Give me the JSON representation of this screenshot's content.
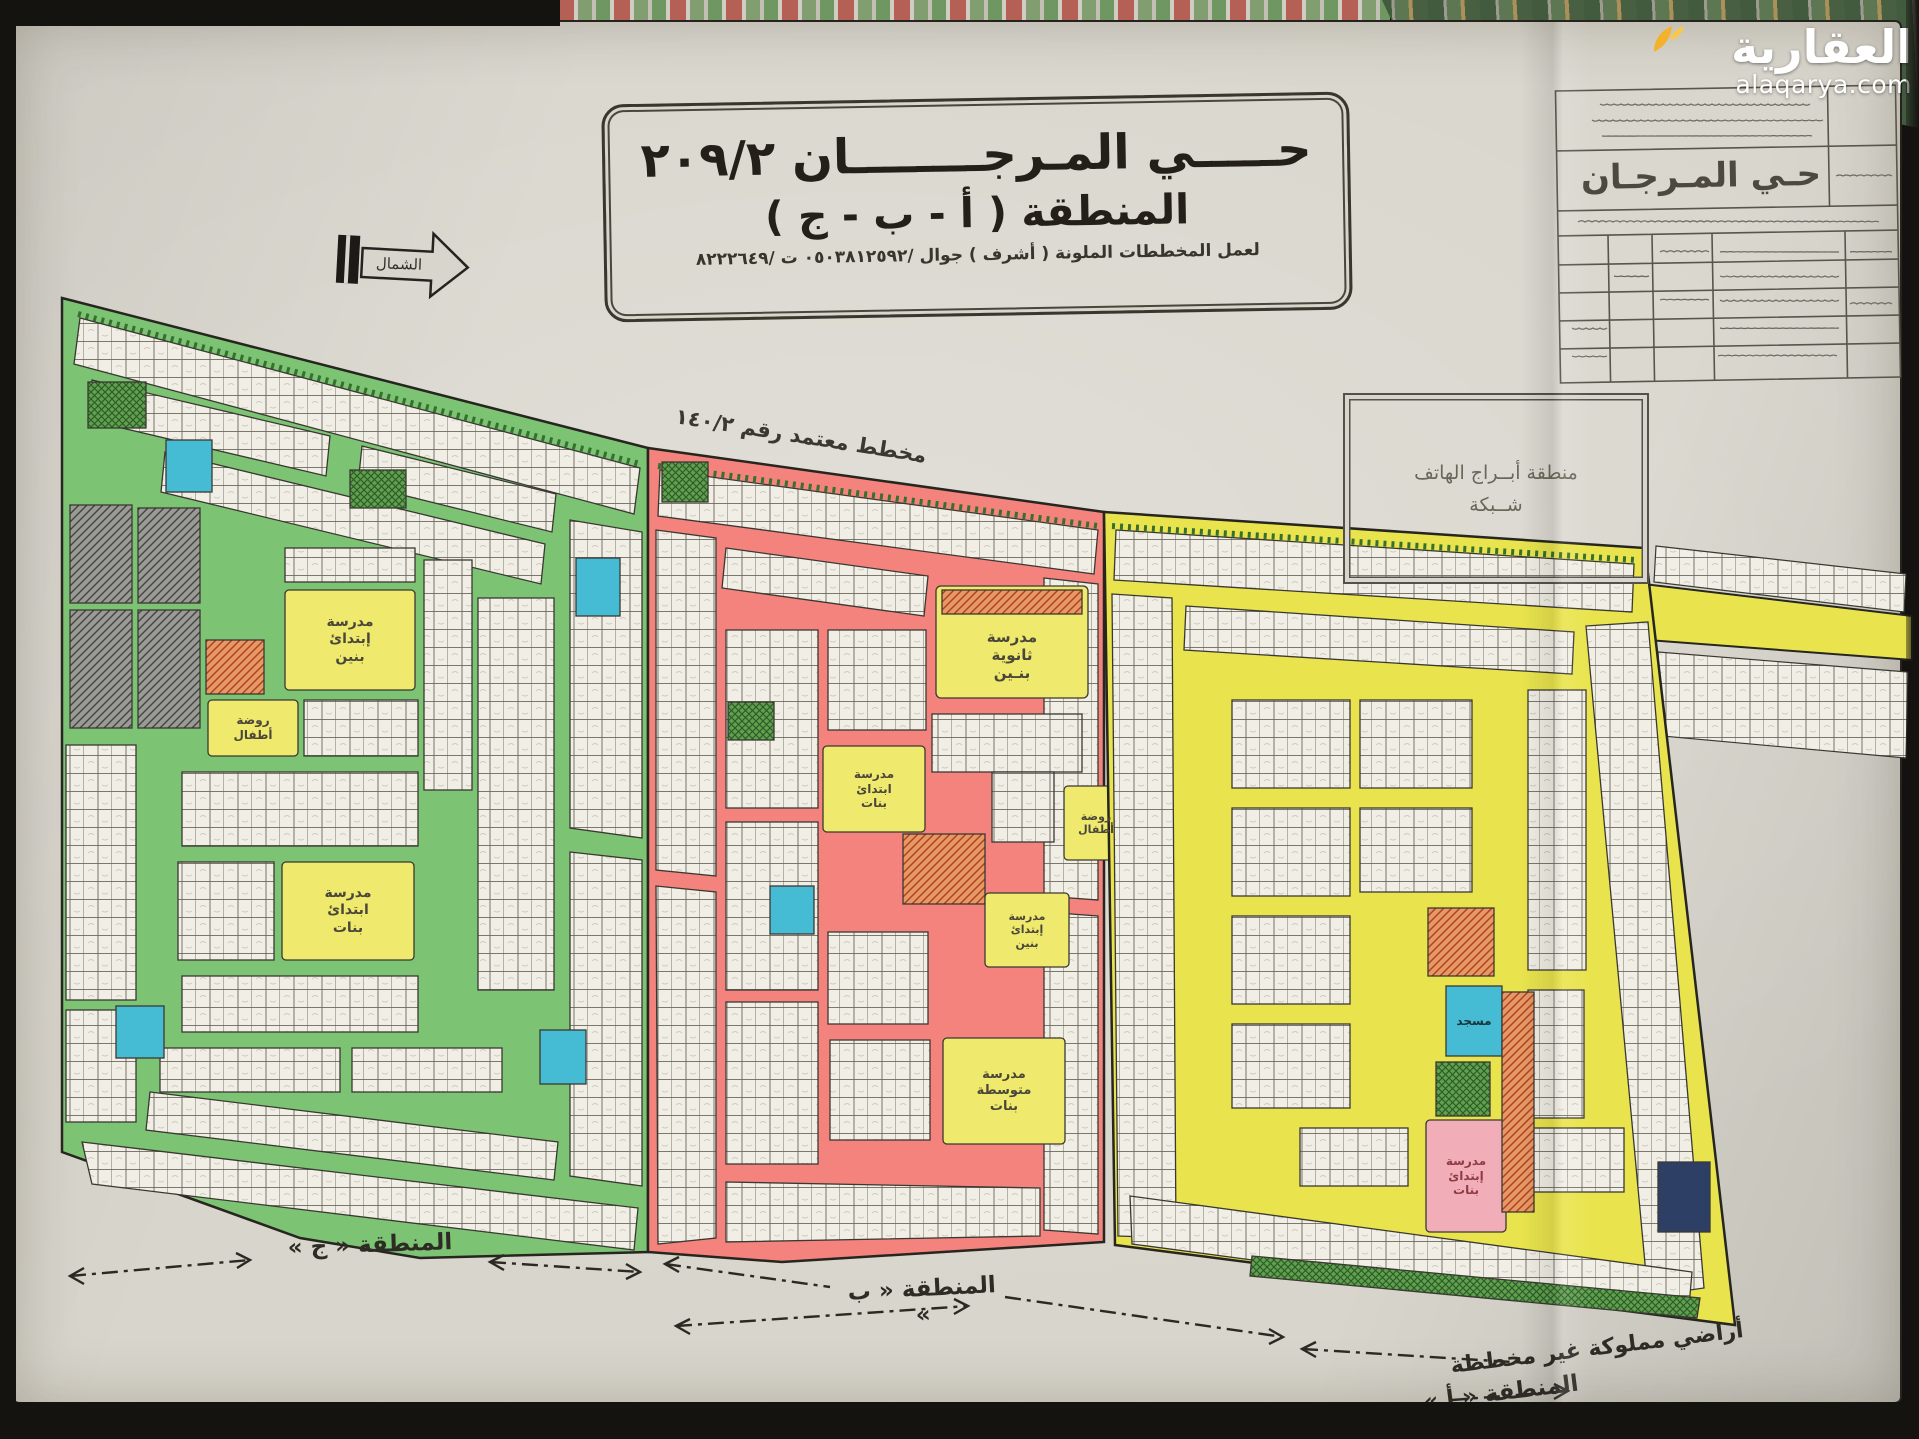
{
  "brand": {
    "name": "العقارية",
    "domain": "alaqarya.com"
  },
  "header": {
    "title_line1": "حـــــي المـرجــــــــان ٢٠٩/٢",
    "title_line2": "المنطقة ( أ - ب - ج )",
    "title_line3": "لعمل المخططات الملونة ( أشرف ) جوال /٠٥٠٣٨١٢٥٩٢ ت /٨٢٢٢٦٤٩",
    "north_label": "الشمال"
  },
  "title_block": {
    "project_name": "حـي المـرجـان"
  },
  "notes": {
    "phone_towers_line1": "منطقة أبــراج الهاتف",
    "phone_towers_line2": "شــبكة",
    "approval": "مخطط معتمد رقم ١٤٠/٢",
    "unplanned_land": "أراضي مملوكة غير مخططة"
  },
  "zones": {
    "c": {
      "label": "المنطقة « ج »",
      "color": "#7cc474"
    },
    "b": {
      "label": "المنطقة « ب »",
      "color": "#f5837d"
    },
    "a": {
      "label": "المنطقة « أ »",
      "color": "#e9e44d"
    }
  },
  "facilities": {
    "c_primary_boys": "مدرسة\nإبتدائ\nبنين",
    "c_kindergarten": "روضة\nأطفال",
    "c_primary_girls": "مدرسة\nابتدائ\nبنات",
    "b_secondary_boys": "مدرسة\nثانوية\nبنـين",
    "b_primary_girls": "مدرسة\nابتدائ\nبنات",
    "b_kindergarten": "روضة\nأطفال",
    "b_primary_boys": "مدرسة\nإبتدائ\nبنين",
    "b_middle_girls": "مدرسة\nمتوسطة\nبنات",
    "a_mosque": "مسجد",
    "a_primary_girls": "مدرسة\nإبتدائ\nبنات"
  },
  "palette": {
    "paper": "#d8d5cc",
    "street_green": "#7cc474",
    "street_red": "#f5837d",
    "street_yellow": "#e9e44d",
    "mosque_cyan": "#45bcd4",
    "school_yellow": "#efe96e",
    "school_pink": "#f2aeb8",
    "plot_white": "#f1eee5"
  }
}
